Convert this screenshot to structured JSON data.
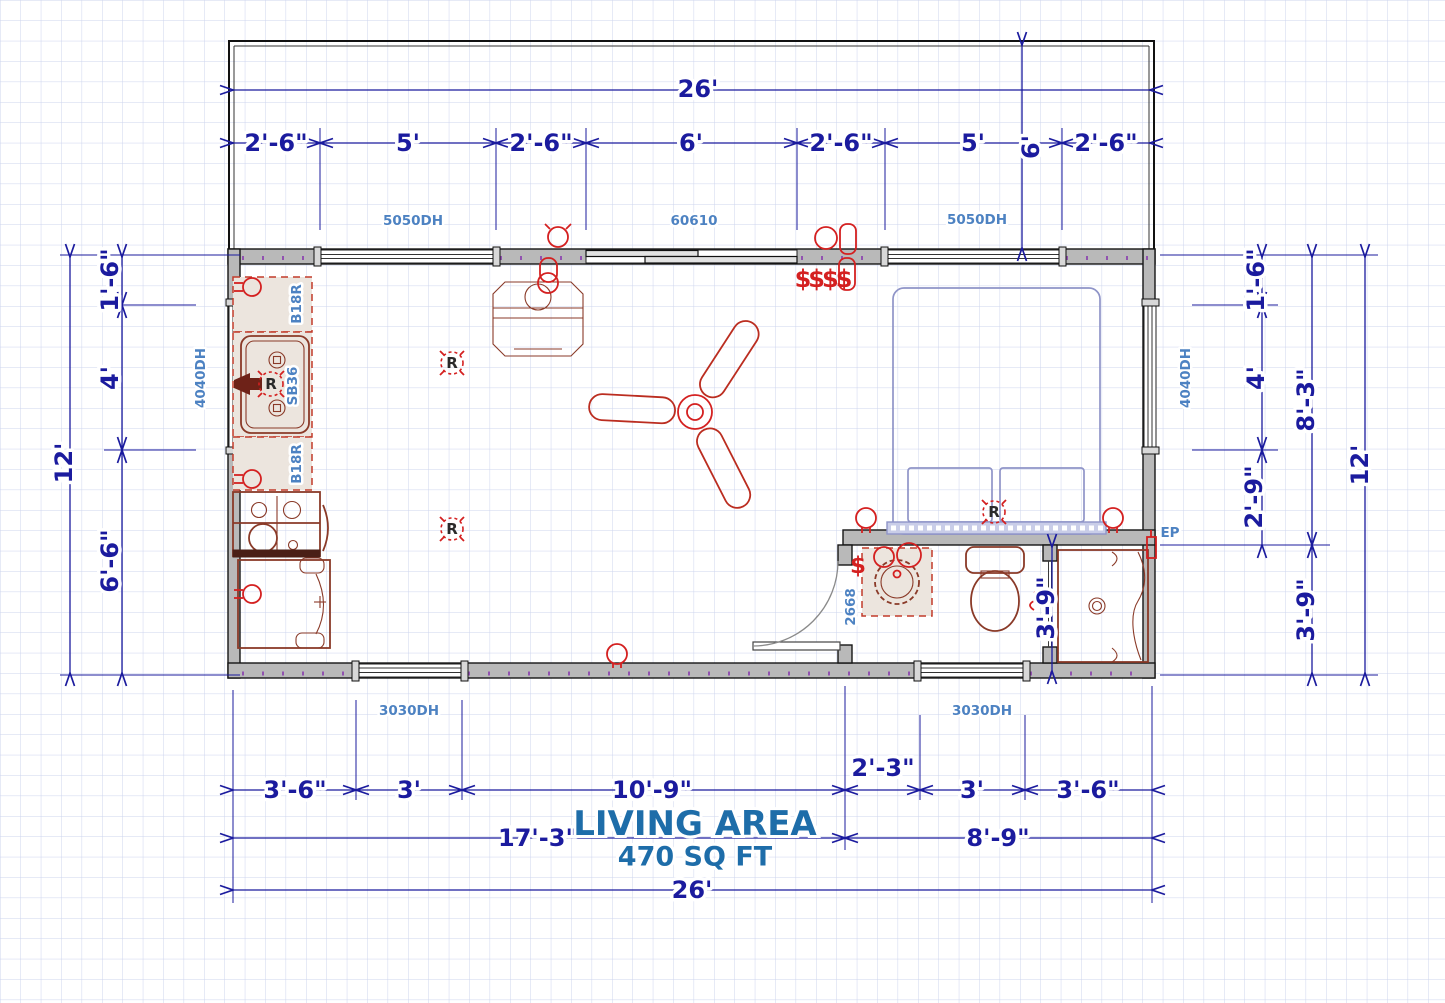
{
  "title": {
    "name": "LIVING AREA",
    "area": "470 SQ FT"
  },
  "dims": {
    "top_overall": "26'",
    "top_segs": [
      "2'-6\"",
      "5'",
      "2'-6\"",
      "6'",
      "2'-6\"",
      "5'",
      "2'-6\""
    ],
    "porch_depth": "6'",
    "left_overall": "12'",
    "left_segs": [
      "1'-6\"",
      "4'",
      "6'-6\""
    ],
    "right_segs": [
      "1'-6\"",
      "4'",
      "2'-9\""
    ],
    "right_mid": [
      "8'-3\"",
      "3'-9\""
    ],
    "right_overall": "12'",
    "bottom_segs": [
      "3'-6\"",
      "3'",
      "10'-9\"",
      "2'-3\"",
      "3'",
      "3'-6\""
    ],
    "bottom_left_span": "17'-3\"",
    "bottom_right_span": "8'-9\"",
    "bottom_overall": "26'",
    "shower_width": "3'-9\""
  },
  "labels": {
    "window_top_left": "5050DH",
    "door_top": "60610",
    "window_top_right": "5050DH",
    "window_left": "4040DH",
    "window_right": "4040DH",
    "window_bottom_left": "3030DH",
    "window_bottom_right": "3030DH",
    "bath_door": "2668",
    "electrical_panel": "EP",
    "cabinet_top": "B18R",
    "cabinet_bottom": "B18R",
    "sink_base": "SB36"
  },
  "symbols": {
    "recessed": "R",
    "switch": "$",
    "switch_bank": "$$$$"
  },
  "colors": {
    "dimension": "#1b1b9e",
    "part_label": "#4d82c2",
    "title": "#1e6da9",
    "fixture": "#8a3a28",
    "electrical": "#d42020",
    "bed": "#8f94c8",
    "wall_fill": "#b9b9b9",
    "grid": "#cdd4ee"
  }
}
